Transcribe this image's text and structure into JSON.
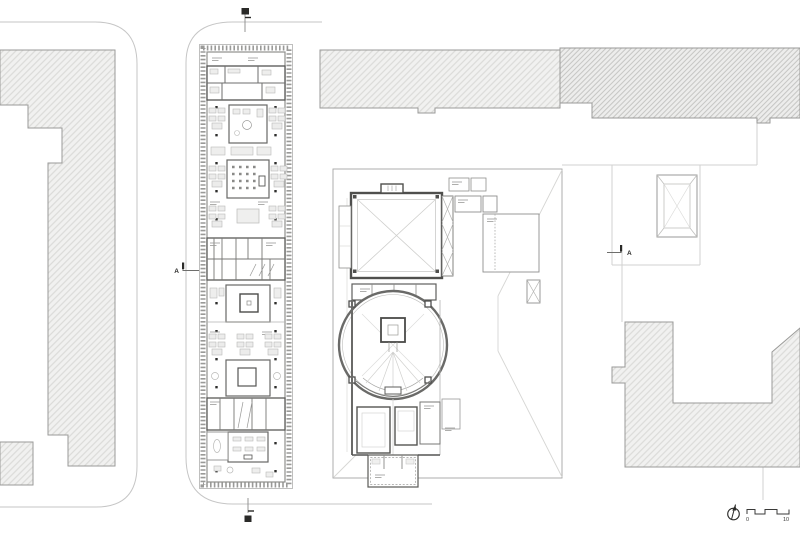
{
  "drawing": {
    "colors": {
      "street_line": "#c6c6c6",
      "hatch_fill": "#f1f1f0",
      "hatch_line_light": "#d9d9d7",
      "hatch_line_dark": "#c5c5c3",
      "building_edge": "#9a9a98",
      "wall_dark": "#4f4f4d",
      "wall_mid": "#6e6e6c",
      "detail_light": "#c9c9c7",
      "marker_black": "#2a2a28",
      "text": "#3a3a38"
    },
    "icons": {
      "north_arrow": "north-arrow-compass",
      "section_cut_top": "section-cut-marker",
      "section_cut_bottom": "section-cut-marker"
    },
    "section_markers": {
      "left_label": "A",
      "right_label": "A"
    },
    "scale_bar": {
      "zero_label": "0",
      "ten_label": "10"
    }
  }
}
